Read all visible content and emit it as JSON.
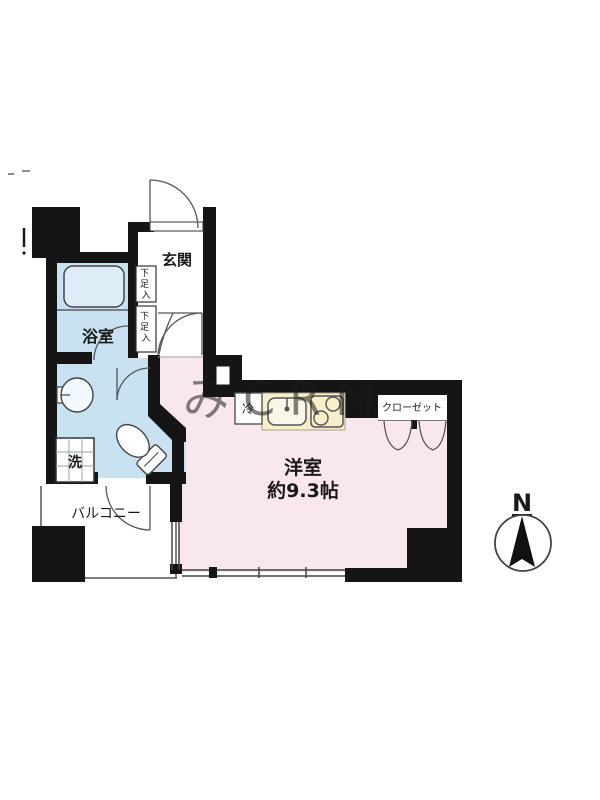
{
  "plan": {
    "rooms": {
      "genkan": "玄関",
      "bathroom": "浴室",
      "shoe": {
        "c0": "下",
        "c1": "足",
        "c2": "入"
      },
      "washer": "洗",
      "fridge": "冷",
      "closet": "クローゼット",
      "balcony": "バルコニー",
      "main_room_name": "洋室",
      "main_room_size": "約9.3帖"
    },
    "compass": {
      "north": "N"
    },
    "watermark": "みCRM",
    "colors": {
      "wet_area": "#c9e2f1",
      "tub": "#dcedf8",
      "main_room": "#f9e7ee",
      "kitchen_counter": "#f6efca",
      "wall": "#151515"
    }
  }
}
